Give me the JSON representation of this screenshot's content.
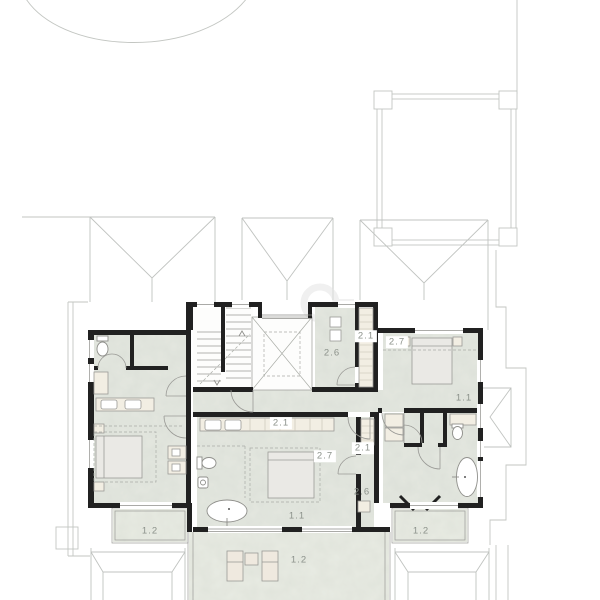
{
  "plan": {
    "room_labels": [
      {
        "id": "upper-storage-2-6",
        "text": "2.6",
        "x": 332,
        "y": 353,
        "boxed": false
      },
      {
        "id": "upper-closet-2-1",
        "text": "2.1",
        "x": 366,
        "y": 336,
        "boxed": true
      },
      {
        "id": "bedroom-right-bed-2-7",
        "text": "2.7",
        "x": 397,
        "y": 342,
        "boxed": true
      },
      {
        "id": "bedroom-right-1-1",
        "text": "1.1",
        "x": 464,
        "y": 398,
        "boxed": false
      },
      {
        "id": "closet-column-2-1",
        "text": "2.1",
        "x": 363,
        "y": 448,
        "boxed": true
      },
      {
        "id": "closet-column-2-6",
        "text": "2.6",
        "x": 362,
        "y": 492,
        "boxed": false
      },
      {
        "id": "master-vanity-2-1",
        "text": "2.1",
        "x": 281,
        "y": 423,
        "boxed": true
      },
      {
        "id": "master-bed-2-7",
        "text": "2.7",
        "x": 325,
        "y": 456,
        "boxed": true
      },
      {
        "id": "master-room-1-1",
        "text": "1.1",
        "x": 297,
        "y": 516,
        "boxed": false
      },
      {
        "id": "balcony-left-1-2",
        "text": "1.2",
        "x": 150,
        "y": 531,
        "boxed": false
      },
      {
        "id": "balcony-right-1-2",
        "text": "1.2",
        "x": 421,
        "y": 531,
        "boxed": false
      },
      {
        "id": "terrace-1-2",
        "text": "1.2",
        "x": 299,
        "y": 560,
        "boxed": false
      }
    ],
    "colors": {
      "label_text": "#8b918a",
      "wall": "#212121",
      "floor_texture": "#e4e7e0",
      "furniture_fill": "#f2eee3",
      "outline_light": "#c3c6c2"
    }
  }
}
